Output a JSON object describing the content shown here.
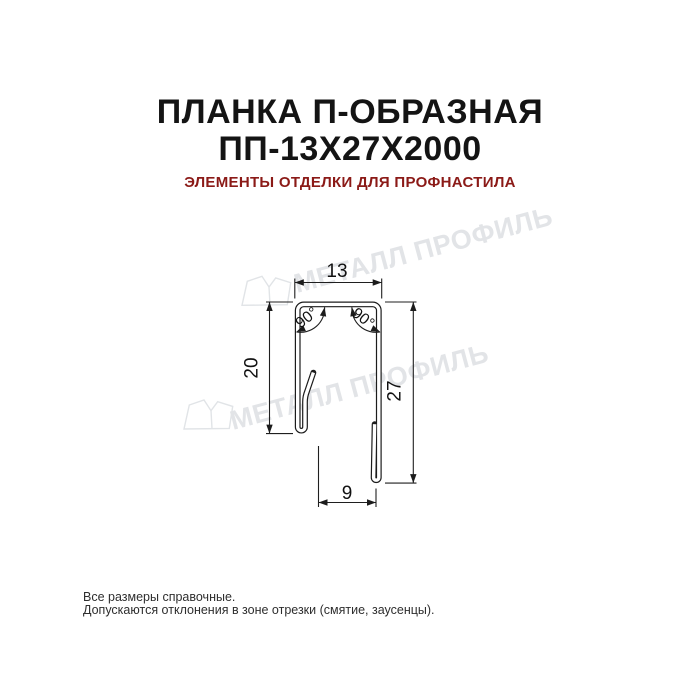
{
  "header": {
    "title_line1": "ПЛАНКА П-ОБРАЗНАЯ",
    "title_line2": "ПП-13Х27Х2000",
    "subtitle": "ЭЛЕМЕНТЫ ОТДЕЛКИ ДЛЯ ПРОФНАСТИЛА",
    "title_color": "#141414",
    "subtitle_color": "#8B1A17"
  },
  "drawing": {
    "type": "profile-cross-section",
    "line_color": "#1c1c1c",
    "dimensions": {
      "top_width": "13",
      "left_height": "20",
      "right_height": "27",
      "bottom_opening": "9",
      "corner_angle_left": "90°",
      "corner_angle_right": "90°"
    }
  },
  "watermark": {
    "text": "МЕТАЛЛ ПРОФИЛЬ",
    "logo": "metall-profil-logo",
    "color": "#e2e4e7"
  },
  "footer": {
    "line1": "Все размеры справочные.",
    "line2": "Допускаются отклонения в зоне отрезки (смятие, заусенцы)."
  }
}
